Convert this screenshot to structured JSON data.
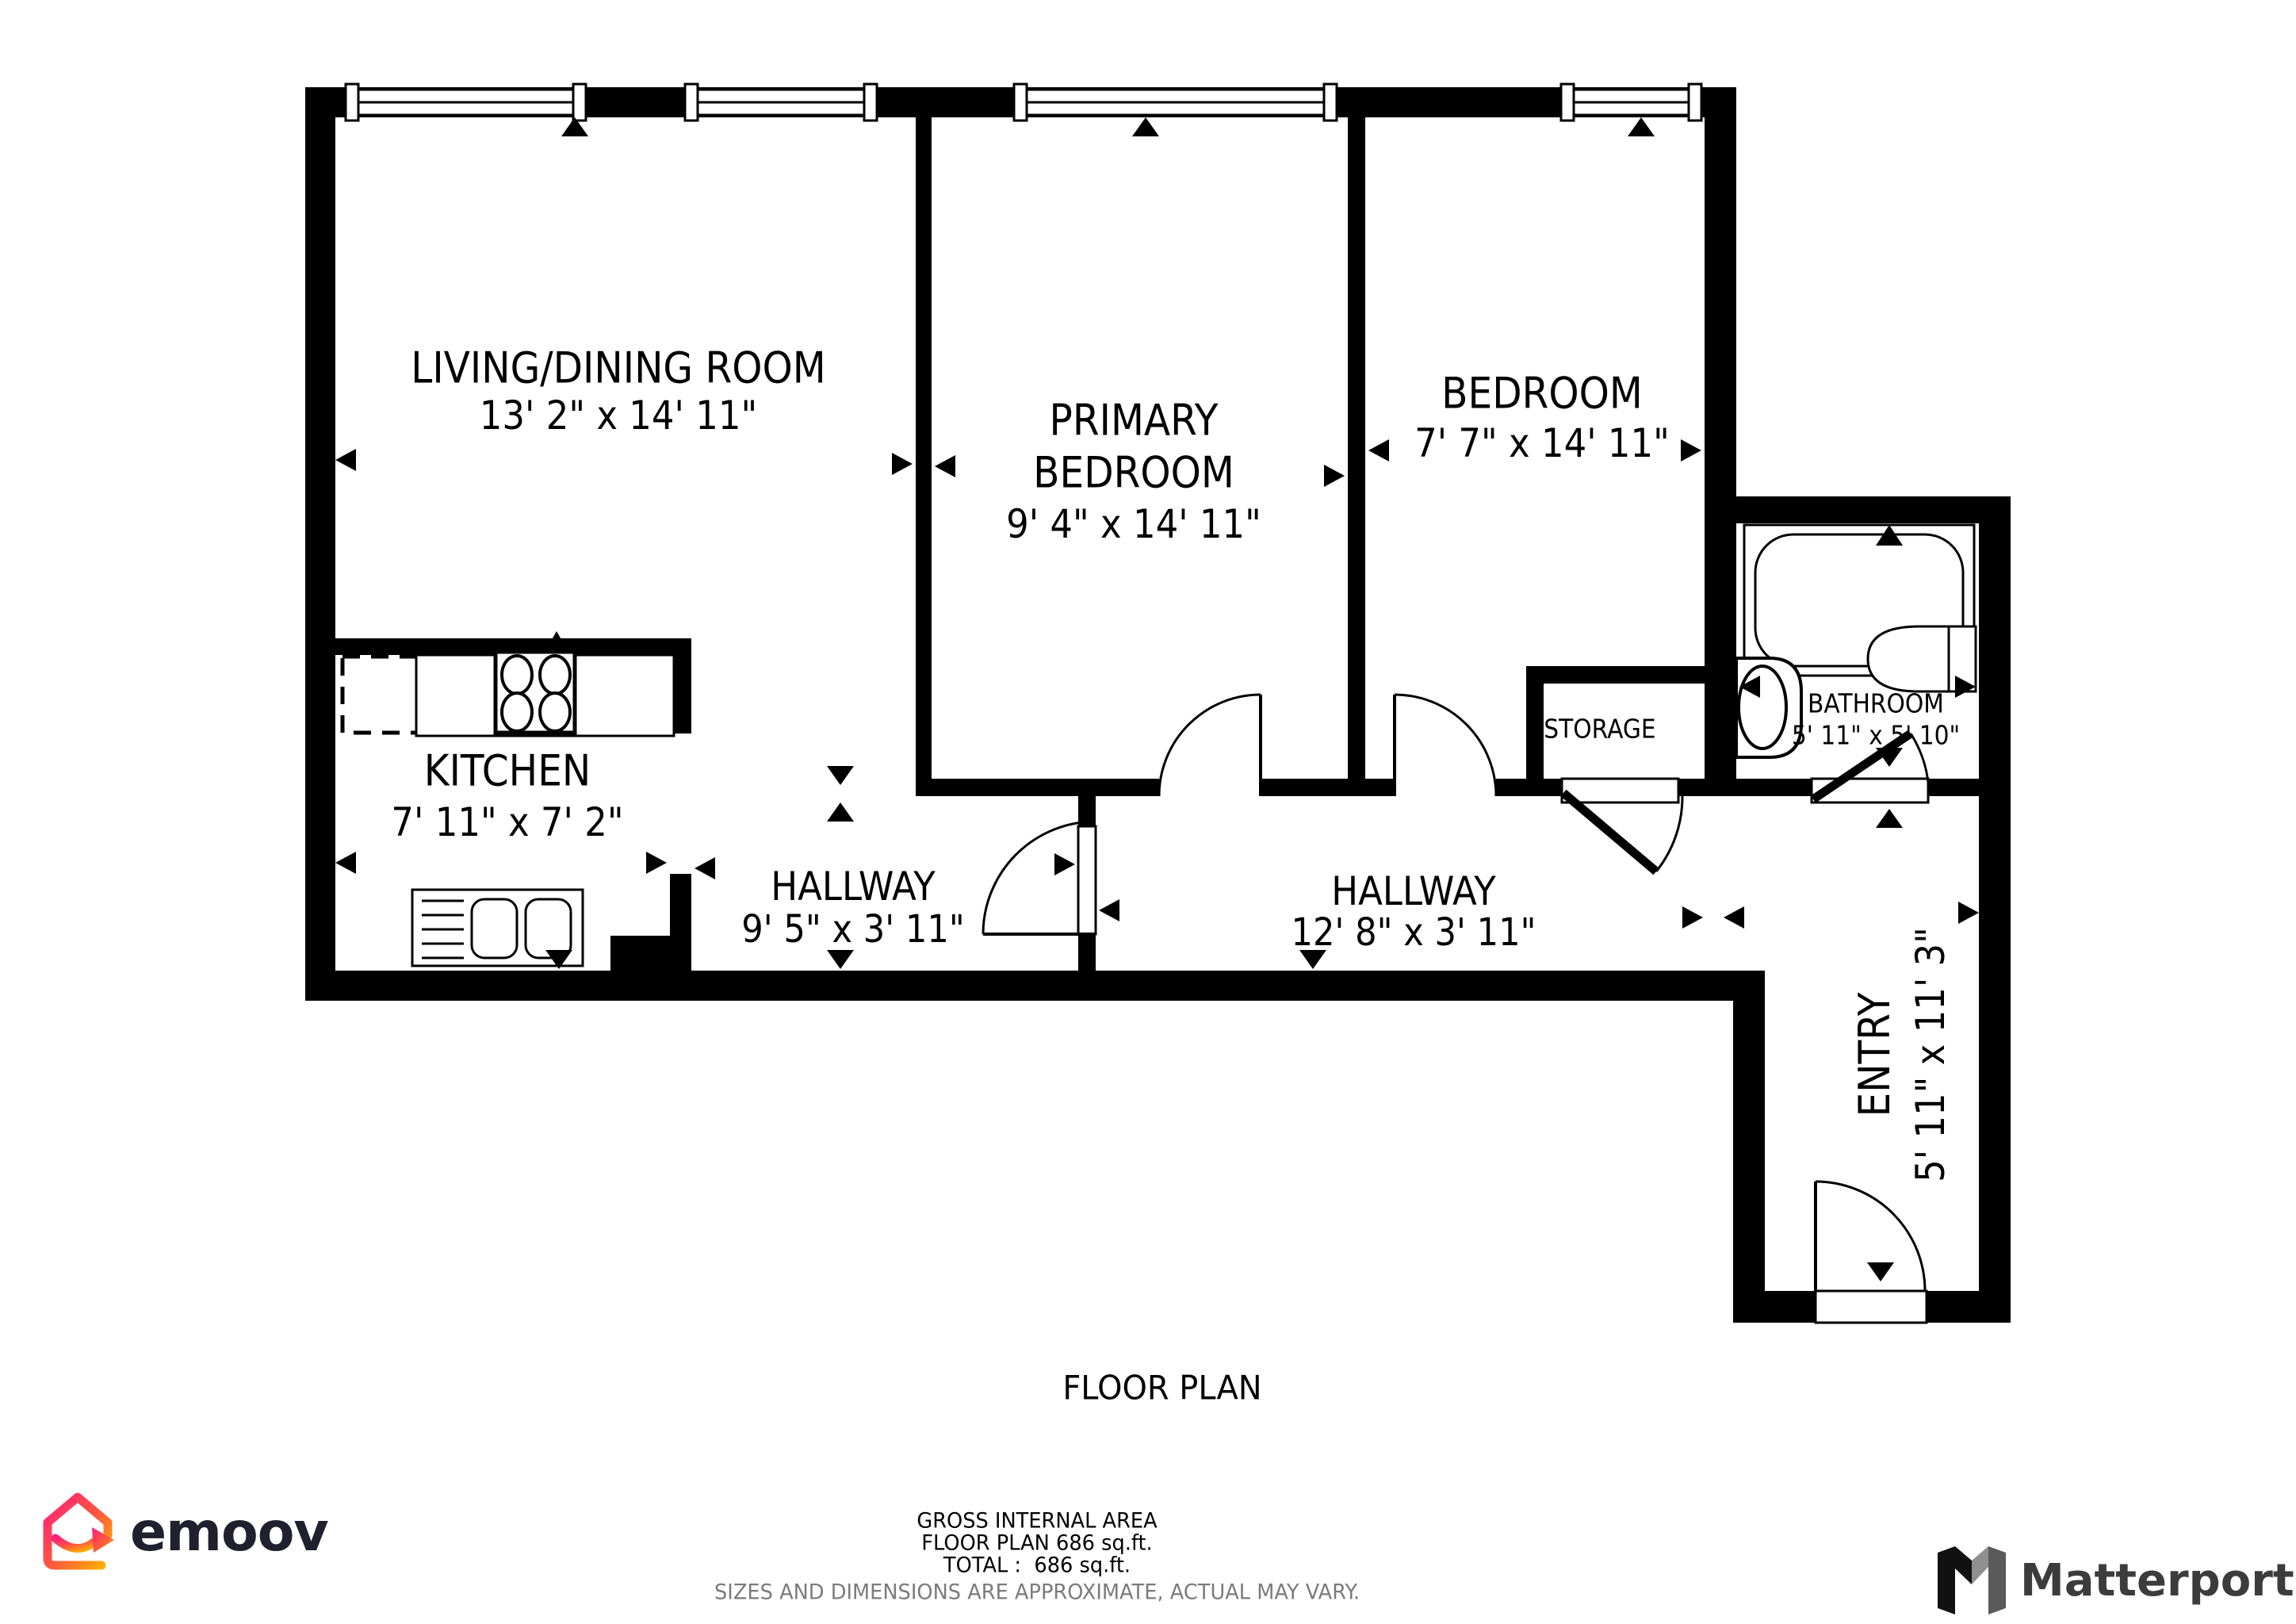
{
  "rooms": {
    "living": {
      "name": "LIVING/DINING ROOM",
      "dims": "13' 2\" x 14' 11\""
    },
    "primary": {
      "name_line1": "PRIMARY",
      "name_line2": "BEDROOM",
      "dims": "9' 4\" x 14' 11\""
    },
    "bedroom": {
      "name": "BEDROOM",
      "dims": "7' 7\" x 14' 11\""
    },
    "kitchen": {
      "name": "KITCHEN",
      "dims": "7' 11\" x 7' 2\""
    },
    "hallway1": {
      "name": "HALLWAY",
      "dims": "9' 5\" x 3' 11\""
    },
    "hallway2": {
      "name": "HALLWAY",
      "dims": "12' 8\" x 3' 11\""
    },
    "storage": {
      "name": "STORAGE"
    },
    "bathroom": {
      "name": "BATHROOM",
      "dims": "5' 11\" x 5' 10\""
    },
    "entry": {
      "name": "ENTRY",
      "dims": "5' 11\" x 11' 3\""
    }
  },
  "footer": {
    "plan_title": "FLOOR PLAN",
    "area_heading": "GROSS INTERNAL AREA",
    "area_line": "FLOOR PLAN 686 sq.ft.",
    "total_line": "TOTAL :  686 sq.ft.",
    "disclaimer": "SIZES AND DIMENSIONS ARE APPROXIMATE, ACTUAL MAY VARY."
  },
  "branding": {
    "emoov_label": "emoov",
    "matterport_label": "Matterport"
  },
  "icons": {
    "emoov_house": "house-gradient-arrow-icon",
    "matterport_m": "matterport-folded-m-icon"
  },
  "colors": {
    "walls": "#000000",
    "text": "#000000",
    "disclaimer": "#7b7b7b",
    "emoov_text": "#20202e",
    "emoov_pink": "#ff1f7c",
    "emoov_orange": "#ffb400",
    "matterport_text": "#3c3c3c",
    "matterport_gray": "#8f8f8f"
  }
}
